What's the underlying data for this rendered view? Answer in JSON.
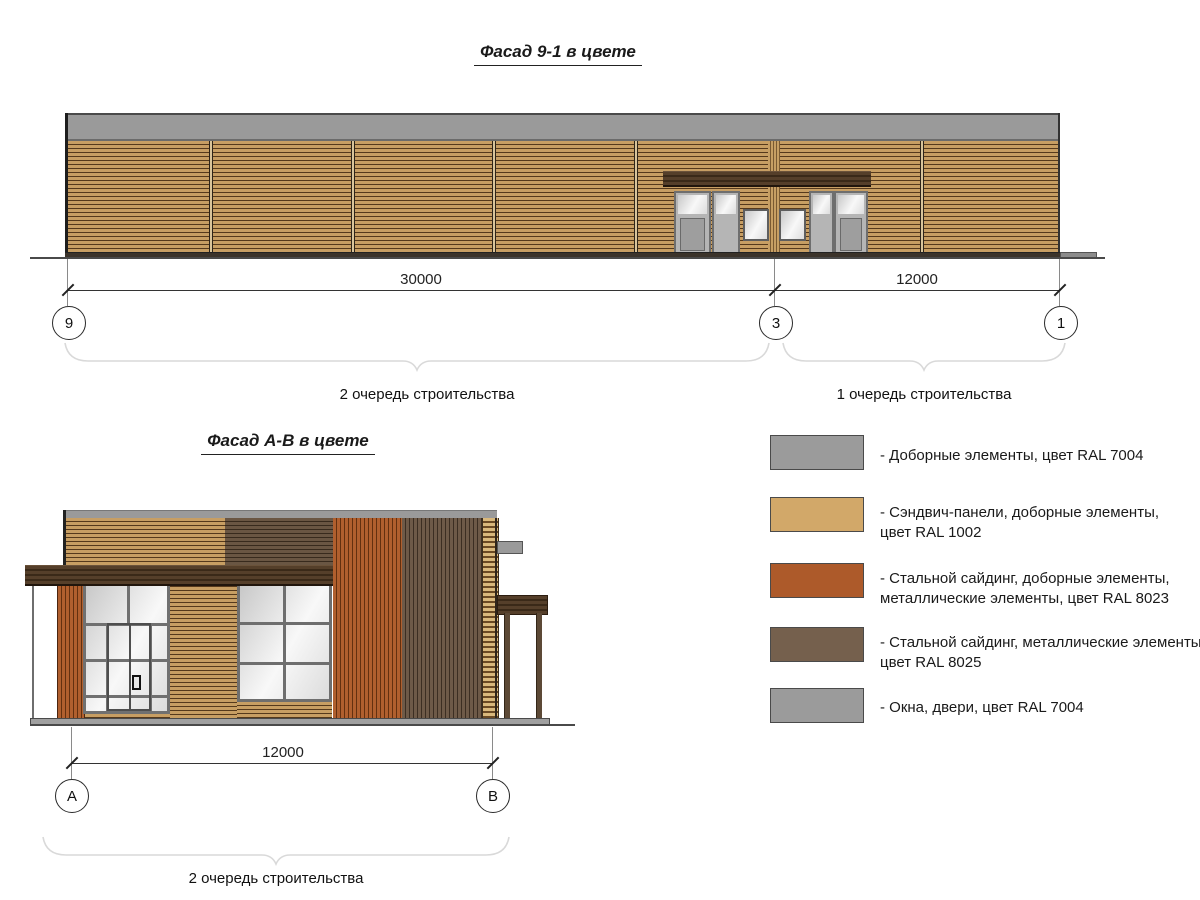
{
  "drawing": {
    "facade1": {
      "title": "Фасад 9-1 в цвете",
      "dims": {
        "left": "30000",
        "right": "12000"
      },
      "grids": [
        "9",
        "3",
        "1"
      ],
      "phase_labels": {
        "left": "2 очередь строительства",
        "right": "1 очередь строительства"
      }
    },
    "facade2": {
      "title": "Фасад А-В в цвете",
      "dim": "12000",
      "grids": [
        "А",
        "В"
      ],
      "phase_label": "2 очередь строительства"
    },
    "legend": {
      "items": [
        {
          "color": "#9b9b9b",
          "lines": [
            "- Доборные элементы, цвет RAL 7004"
          ]
        },
        {
          "color": "#d2a869",
          "lines": [
            "- Сэндвич-панели, доборные элементы,",
            "цвет RAL 1002"
          ]
        },
        {
          "color": "#ad5a2a",
          "lines": [
            "- Стальной сайдинг, доборные элементы,",
            "металлические элементы, цвет RAL 8023"
          ]
        },
        {
          "color": "#75604d",
          "lines": [
            "- Стальной сайдинг, металлические элементы,",
            "цвет RAL 8025"
          ]
        },
        {
          "color": "#9b9b9b",
          "lines": [
            "- Окна, двери, цвет RAL 7004"
          ]
        }
      ]
    }
  }
}
